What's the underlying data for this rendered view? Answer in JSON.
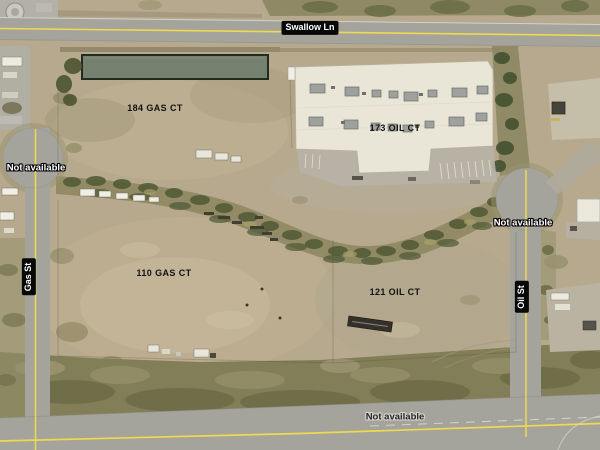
{
  "map": {
    "street_labels": {
      "top": "Swallow Ln",
      "left": "Gas St",
      "right": "Oil St"
    },
    "parcel_labels": [
      "184 GAS CT",
      "173 OIL CT",
      "110 GAS CT",
      "121 OIL CT"
    ],
    "status_labels": {
      "left_culdesac": "Not available",
      "right_culdesac": "Not available",
      "bottom_road": "Not available"
    },
    "colors": {
      "terrain": "#b7a98d",
      "road": "#a5a49c",
      "centerline_yellow": "#eed94f",
      "vegetation": "#7e7a52",
      "building_roof": "#eae6d7",
      "pond": "#75816f",
      "street_label_bg": "#070707",
      "street_label_text": "#ffffff"
    }
  }
}
